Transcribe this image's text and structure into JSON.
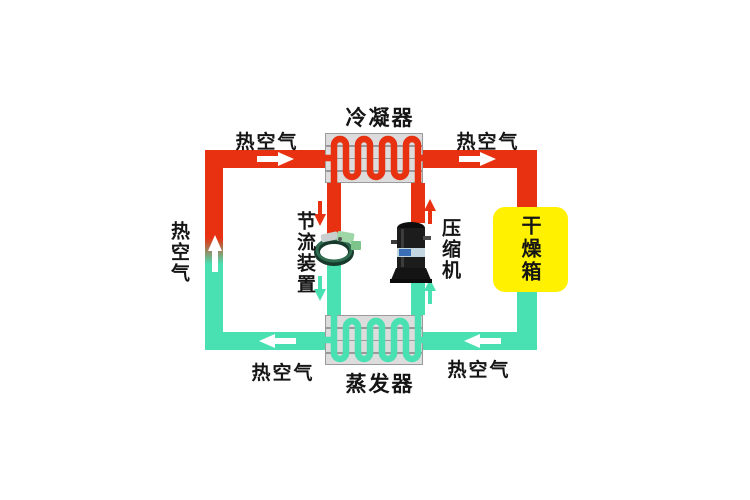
{
  "diagram": {
    "components": {
      "condenser": {
        "label": "冷凝器"
      },
      "evaporator": {
        "label": "蒸发器"
      },
      "throttle_device": {
        "label": "节流装置"
      },
      "compressor": {
        "label": "压缩机"
      },
      "drying_box": {
        "label": "干燥箱"
      }
    },
    "air_flow": {
      "top_left": "热空气",
      "top_right": "热空气",
      "left": "热空气",
      "bottom_left": "热空气",
      "bottom_right": "热空气"
    },
    "colors": {
      "hot_air_pipe": "#e73111",
      "cool_air_pipe": "#49e0b2",
      "drying_box_fill": "#fff100",
      "heat_exchanger_fill": "#dcdcdc",
      "label_text": "#151515",
      "arrow_white": "#ffffff"
    }
  }
}
